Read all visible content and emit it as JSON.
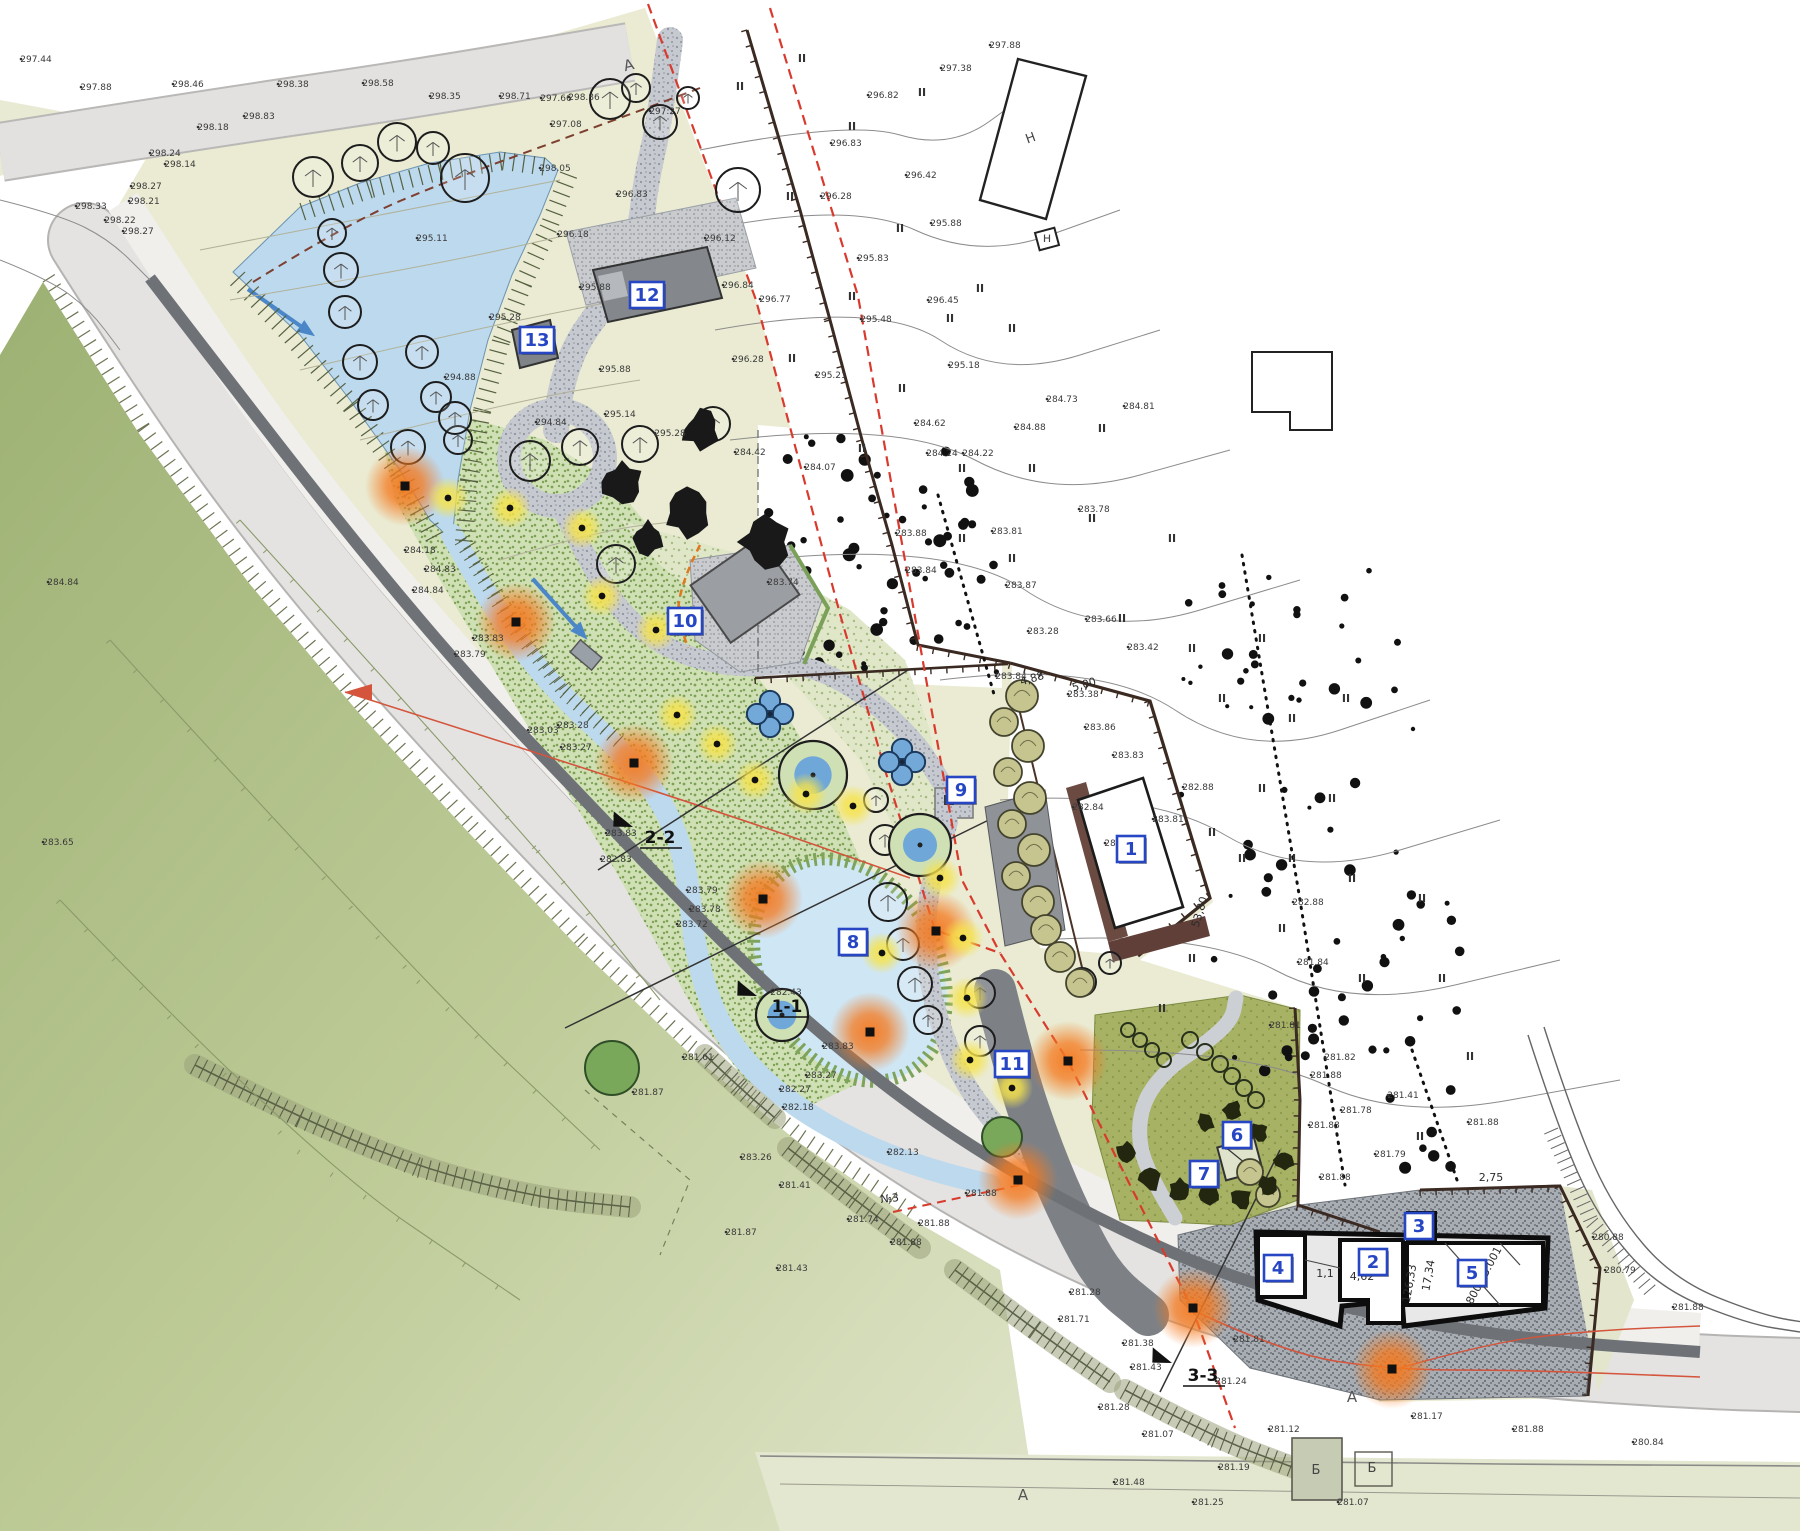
{
  "map": {
    "type": "landscape-site-plan",
    "accent_colors": {
      "callout_blue": "#2746c4",
      "lamp_orange": "#f4791f",
      "lamp_yellow": "#f6e34b",
      "water": "#bcd9ee",
      "boundary_red": "#d93a2e",
      "park_pale": "#eaebd2",
      "slope_green": "#a9bb80"
    },
    "callouts": [
      {
        "num": "1",
        "x": 1131,
        "y": 849
      },
      {
        "num": "2",
        "x": 1373,
        "y": 1262
      },
      {
        "num": "3",
        "x": 1419,
        "y": 1226
      },
      {
        "num": "4",
        "x": 1278,
        "y": 1268
      },
      {
        "num": "5",
        "x": 1472,
        "y": 1273
      },
      {
        "num": "6",
        "x": 1237,
        "y": 1135
      },
      {
        "num": "7",
        "x": 1204,
        "y": 1174
      },
      {
        "num": "8",
        "x": 853,
        "y": 942
      },
      {
        "num": "9",
        "x": 961,
        "y": 790
      },
      {
        "num": "10",
        "x": 685,
        "y": 621
      },
      {
        "num": "11",
        "x": 1012,
        "y": 1064
      },
      {
        "num": "12",
        "x": 647,
        "y": 295
      },
      {
        "num": "13",
        "x": 537,
        "y": 340
      }
    ],
    "sections": [
      {
        "label": "2-2",
        "x": 660,
        "y": 843,
        "ax": 633,
        "ay": 827,
        "arot": -155
      },
      {
        "label": "1-1",
        "x": 787,
        "y": 1012,
        "ax": 757,
        "ay": 996,
        "arot": -155
      },
      {
        "label": "3-3",
        "x": 1203,
        "y": 1381,
        "ax": 1172,
        "ay": 1363,
        "arot": -155
      }
    ],
    "road_marks": [
      {
        "t": "A",
        "x": 630,
        "y": 70,
        "rot": -14
      },
      {
        "t": "A",
        "x": 1023,
        "y": 1500,
        "rot": 0
      },
      {
        "t": "A",
        "x": 1352,
        "y": 1402,
        "rot": 0
      }
    ],
    "letters": [
      {
        "t": "Н",
        "x": 1032,
        "y": 142,
        "rot": -20
      },
      {
        "t": "н",
        "x": 1047,
        "y": 242,
        "rot": 0
      },
      {
        "t": "Б",
        "x": 1316,
        "y": 1474,
        "rot": 0
      },
      {
        "t": "Б",
        "x": 1372,
        "y": 1472,
        "rot": 0
      }
    ],
    "dimensions": [
      {
        "t": "4,88",
        "x": 1033,
        "y": 682,
        "rot": -16
      },
      {
        "t": "5,00",
        "x": 1085,
        "y": 688,
        "rot": -16
      },
      {
        "t": "53,80",
        "x": 1203,
        "y": 913,
        "rot": -73
      },
      {
        "t": "№3",
        "x": 890,
        "y": 1202,
        "rot": -6
      },
      {
        "t": "2,75",
        "x": 1491,
        "y": 1181,
        "rot": 0
      },
      {
        "t": "1,1",
        "x": 1325,
        "y": 1277,
        "rot": 0
      },
      {
        "t": "4,62",
        "x": 1362,
        "y": 1280,
        "rot": 0
      },
      {
        "t": "126,33",
        "x": 1413,
        "y": 1284,
        "rot": -80
      },
      {
        "t": "17,34",
        "x": 1432,
        "y": 1276,
        "rot": -80
      },
      {
        "t": "800:03:001",
        "x": 1487,
        "y": 1277,
        "rot": -62
      }
    ],
    "veg_symbol": "II",
    "veg_marks": [
      [
        740,
        90
      ],
      [
        802,
        62
      ],
      [
        852,
        130
      ],
      [
        922,
        96
      ],
      [
        790,
        200
      ],
      [
        900,
        232
      ],
      [
        852,
        300
      ],
      [
        950,
        322
      ],
      [
        792,
        362
      ],
      [
        902,
        392
      ],
      [
        980,
        292
      ],
      [
        1012,
        332
      ],
      [
        862,
        452
      ],
      [
        962,
        472
      ],
      [
        1032,
        472
      ],
      [
        1102,
        432
      ],
      [
        1092,
        522
      ],
      [
        1172,
        542
      ],
      [
        962,
        542
      ],
      [
        1012,
        562
      ],
      [
        1122,
        622
      ],
      [
        1192,
        652
      ],
      [
        1262,
        642
      ],
      [
        1222,
        702
      ],
      [
        1292,
        722
      ],
      [
        1346,
        702
      ],
      [
        1262,
        792
      ],
      [
        1332,
        802
      ],
      [
        1212,
        836
      ],
      [
        1292,
        862
      ],
      [
        1352,
        882
      ],
      [
        1422,
        902
      ],
      [
        1282,
        932
      ],
      [
        1192,
        962
      ],
      [
        1442,
        982
      ],
      [
        1362,
        982
      ],
      [
        1162,
        1012
      ],
      [
        1242,
        862
      ],
      [
        1470,
        1060
      ],
      [
        1420,
        1140
      ]
    ],
    "elevations": [
      [
        "297.44",
        28,
        62
      ],
      [
        "297.88",
        88,
        90
      ],
      [
        "298.46",
        180,
        87
      ],
      [
        "298.38",
        285,
        87
      ],
      [
        "298.58",
        370,
        86
      ],
      [
        "298.35",
        437,
        99
      ],
      [
        "298.83",
        251,
        119
      ],
      [
        "298.18",
        205,
        130
      ],
      [
        "298.24",
        157,
        156
      ],
      [
        "298.14",
        172,
        167
      ],
      [
        "298.27",
        138,
        189
      ],
      [
        "298.21",
        136,
        204
      ],
      [
        "298.33",
        83,
        209
      ],
      [
        "298.22",
        112,
        223
      ],
      [
        "298.27",
        130,
        234
      ],
      [
        "298.71",
        507,
        99
      ],
      [
        "297.66",
        548,
        101
      ],
      [
        "298.86",
        576,
        100
      ],
      [
        "297.27",
        657,
        114
      ],
      [
        "297.08",
        558,
        127
      ],
      [
        "298.05",
        547,
        171
      ],
      [
        "296.83",
        624,
        197
      ],
      [
        "296.18",
        565,
        237
      ],
      [
        "295.11",
        424,
        241
      ],
      [
        "296.12",
        712,
        241
      ],
      [
        "296.84",
        730,
        288
      ],
      [
        "296.77",
        767,
        302
      ],
      [
        "295.88",
        587,
        290
      ],
      [
        "296.28",
        740,
        362
      ],
      [
        "295.88",
        607,
        372
      ],
      [
        "295.28",
        497,
        320
      ],
      [
        "294.88",
        452,
        380
      ],
      [
        "295.14",
        612,
        417
      ],
      [
        "294.84",
        543,
        425
      ],
      [
        "295.28",
        662,
        436
      ],
      [
        "297.88",
        997,
        48
      ],
      [
        "297.38",
        948,
        71
      ],
      [
        "296.82",
        875,
        98
      ],
      [
        "296.83",
        838,
        146
      ],
      [
        "296.42",
        913,
        178
      ],
      [
        "296.28",
        828,
        199
      ],
      [
        "295.88",
        938,
        226
      ],
      [
        "295.83",
        865,
        261
      ],
      [
        "296.45",
        935,
        303
      ],
      [
        "295.48",
        868,
        322
      ],
      [
        "295.18",
        956,
        368
      ],
      [
        "295.21",
        823,
        378
      ],
      [
        "284.73",
        1054,
        402
      ],
      [
        "284.81",
        1131,
        409
      ],
      [
        "284.62",
        922,
        426
      ],
      [
        "284.24",
        934,
        456
      ],
      [
        "284.22",
        970,
        456
      ],
      [
        "284.42",
        742,
        455
      ],
      [
        "284.07",
        812,
        470
      ],
      [
        "283.74",
        775,
        585
      ],
      [
        "284.88",
        1022,
        430
      ],
      [
        "283.78",
        1086,
        512
      ],
      [
        "283.81",
        999,
        534
      ],
      [
        "283.88",
        903,
        536
      ],
      [
        "283.84",
        913,
        573
      ],
      [
        "283.87",
        1013,
        588
      ],
      [
        "283.66",
        1093,
        622
      ],
      [
        "283.28",
        1035,
        634
      ],
      [
        "283.42",
        1135,
        650
      ],
      [
        "283.84",
        1003,
        679
      ],
      [
        "283.38",
        1075,
        697
      ],
      [
        "283.86",
        1092,
        730
      ],
      [
        "283.83",
        1120,
        758
      ],
      [
        "282.88",
        1190,
        790
      ],
      [
        "283.81",
        1160,
        822
      ],
      [
        "282.87",
        1112,
        846
      ],
      [
        "282.84",
        1080,
        810
      ],
      [
        "284.18",
        412,
        553
      ],
      [
        "284.83",
        432,
        572
      ],
      [
        "284.84",
        420,
        593
      ],
      [
        "283.83",
        480,
        641
      ],
      [
        "283.79",
        462,
        657
      ],
      [
        "283.28",
        565,
        728
      ],
      [
        "283.27",
        568,
        750
      ],
      [
        "283.83",
        613,
        836
      ],
      [
        "282.83",
        608,
        862
      ],
      [
        "283.79",
        694,
        893
      ],
      [
        "283.78",
        697,
        912
      ],
      [
        "283.72",
        684,
        927
      ],
      [
        "282.43",
        778,
        995
      ],
      [
        "283.83",
        830,
        1049
      ],
      [
        "283.27",
        813,
        1078
      ],
      [
        "282.27",
        787,
        1092
      ],
      [
        "282.88",
        1300,
        905
      ],
      [
        "281.81",
        1277,
        1028
      ],
      [
        "281.82",
        1332,
        1060
      ],
      [
        "281.88",
        1318,
        1078
      ],
      [
        "281.78",
        1348,
        1113
      ],
      [
        "281.88",
        1316,
        1128
      ],
      [
        "281.79",
        1382,
        1157
      ],
      [
        "281.88",
        1327,
        1180
      ],
      [
        "281.84",
        1305,
        965
      ],
      [
        "281.88",
        926,
        1226
      ],
      [
        "281.74",
        855,
        1222
      ],
      [
        "281.88",
        898,
        1245
      ],
      [
        "282.18",
        790,
        1110
      ],
      [
        "283.26",
        748,
        1160
      ],
      [
        "281.41",
        787,
        1188
      ],
      [
        "281.87",
        733,
        1235
      ],
      [
        "281.43",
        784,
        1271
      ],
      [
        "282.13",
        895,
        1155
      ],
      [
        "281.88",
        973,
        1196
      ],
      [
        "281.28",
        1077,
        1295
      ],
      [
        "281.71",
        1066,
        1322
      ],
      [
        "281.38",
        1130,
        1346
      ],
      [
        "281.81",
        1241,
        1342
      ],
      [
        "281.43",
        1138,
        1370
      ],
      [
        "281.28",
        1106,
        1410
      ],
      [
        "281.24",
        1223,
        1384
      ],
      [
        "281.07",
        1150,
        1437
      ],
      [
        "281.12",
        1276,
        1432
      ],
      [
        "281.17",
        1419,
        1419
      ],
      [
        "281.88",
        1520,
        1432
      ],
      [
        "281.48",
        1121,
        1485
      ],
      [
        "281.19",
        1226,
        1470
      ],
      [
        "281.25",
        1200,
        1505
      ],
      [
        "281.07",
        1345,
        1505
      ],
      [
        "280.84",
        1640,
        1445
      ],
      [
        "281.88",
        1680,
        1310
      ],
      [
        "280.88",
        1600,
        1240
      ],
      [
        "280.79",
        1612,
        1273
      ],
      [
        "281.88",
        1475,
        1125
      ],
      [
        "281.41",
        1395,
        1098
      ],
      [
        "281.61",
        690,
        1060
      ],
      [
        "281.87",
        640,
        1095
      ],
      [
        "283.03",
        535,
        733
      ],
      [
        "284.84",
        55,
        585
      ],
      [
        "283.65",
        50,
        845
      ]
    ]
  }
}
